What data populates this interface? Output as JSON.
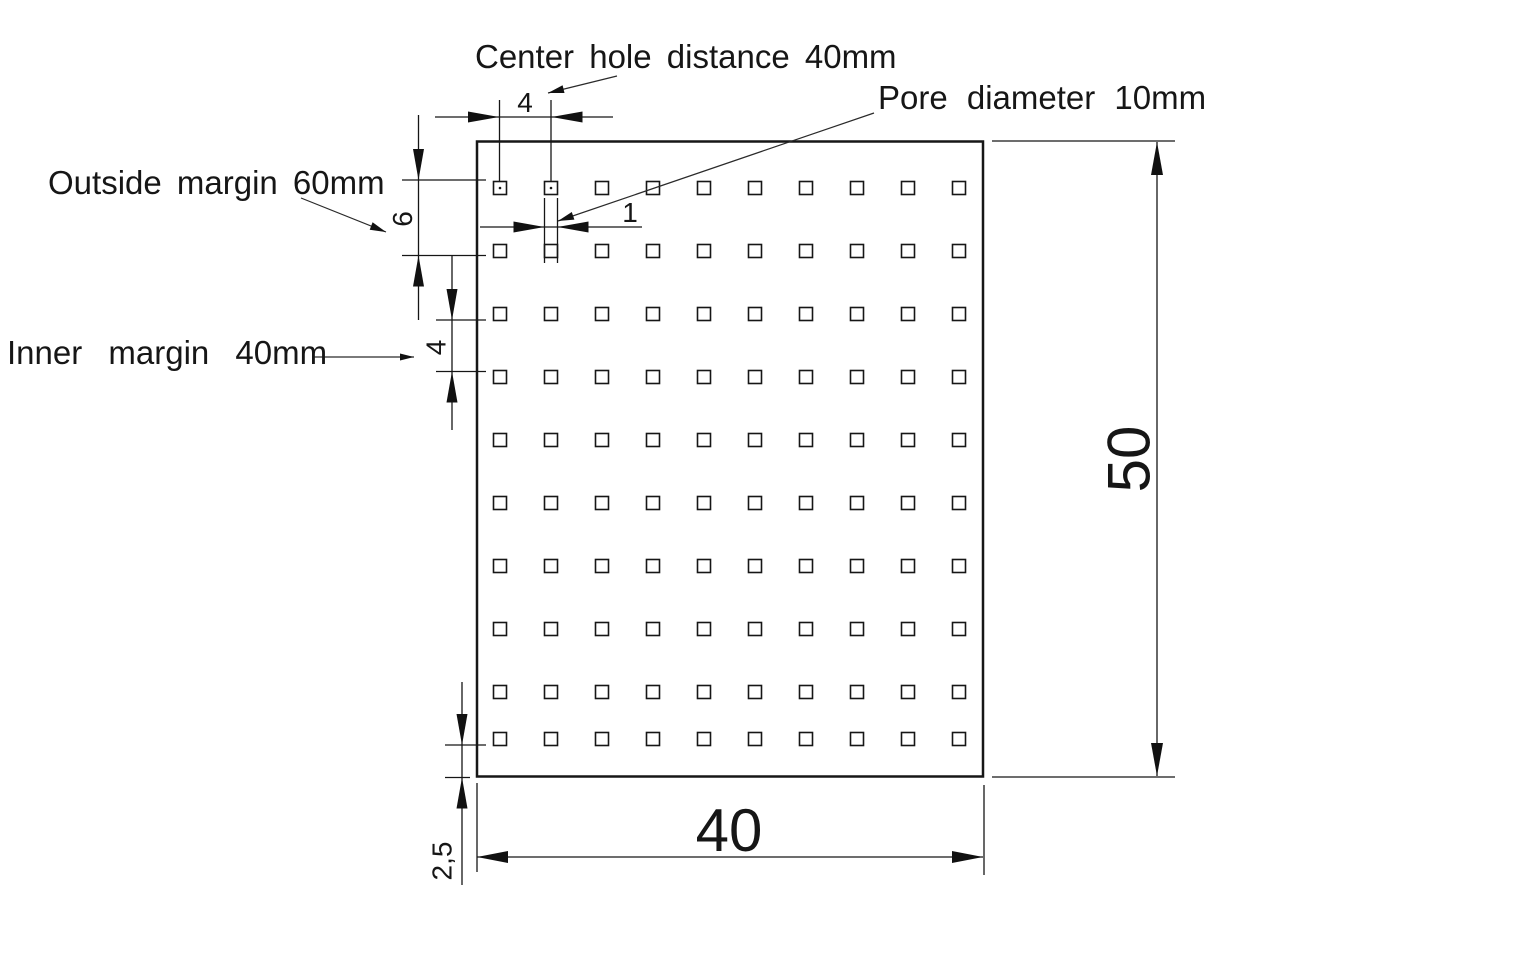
{
  "labels": {
    "center_hole_distance": "Center hole distance 40mm",
    "pore_diameter": "Pore diameter 10mm",
    "outside_margin": "Outside margin 60mm",
    "inner_margin": "Inner margin 40mm"
  },
  "dimensions": {
    "plate_width": "40",
    "plate_height": "50",
    "hole_pitch_top": "4",
    "outside_margin_value": "6",
    "inner_margin_value": "4",
    "pore_width": "1",
    "bottom_margin": "2,5"
  },
  "plate": {
    "hole_rows": 10,
    "hole_cols": 10
  },
  "colors": {
    "line": "#161616",
    "background": "#ffffff"
  }
}
